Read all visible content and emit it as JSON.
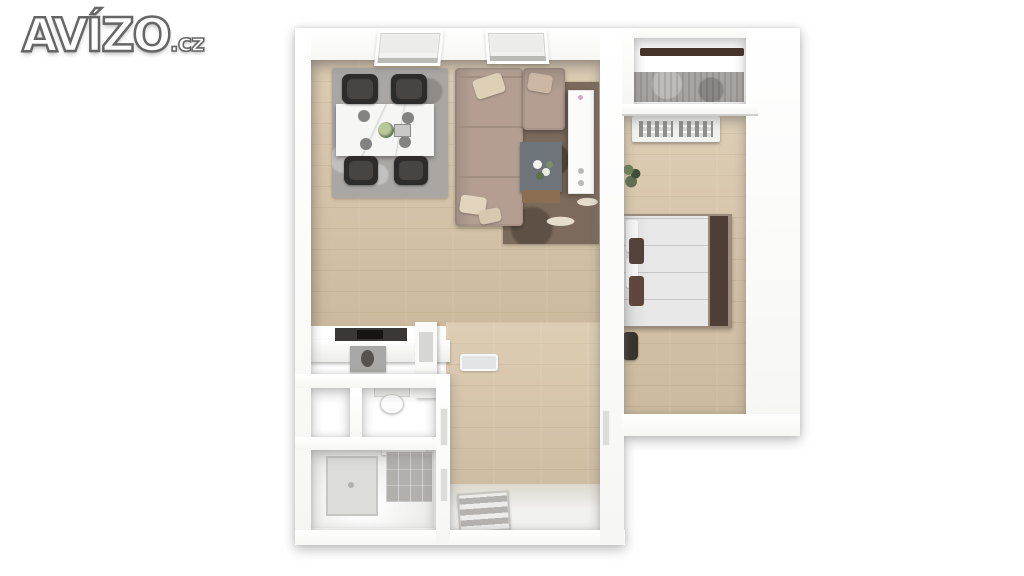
{
  "logo": {
    "text": "AVÍZO",
    "suffix": ".cz"
  },
  "colors": {
    "page-bg": "#ffffff",
    "wall": "#f6f6f4",
    "wood": "#d7c4a6",
    "hall-white": "#f1f1f0",
    "rug-gray": "#a9a6a3",
    "rug-brown": "#7c6a5c",
    "rug-pattern": "#e7ddcd",
    "sofa": "#b39e91",
    "sofa-seam": "#a28e81",
    "pillow-cream": "#decfb7",
    "chair-dark": "#2e2c2a",
    "table-white": "#f6f6f4",
    "coffee-table": "#6e757a",
    "wood-furniture": "#8a6e51",
    "bed-duvet": "#e8e8e9",
    "bed-dark": "#4e3e36",
    "throw-brown": "#54413a",
    "railing": "#46332a",
    "balcony-floor": "#a7a5a2",
    "appliance-dark": "#3a3836",
    "appliance-gray": "#a8a8a6",
    "tile": "#b2b0ad",
    "shower": "#dcdcda",
    "mat": "#b4b2ae",
    "grille": "#8f8f8d",
    "plant-green": "#5f7050",
    "logo-fill": "#fdfdfd",
    "logo-stroke": "#666666"
  },
  "floorplan": {
    "type": "3d-top-down-apartment-render",
    "rooms": [
      "living-room-with-dining",
      "kitchen-nook",
      "wc",
      "closet",
      "bathroom",
      "entry-hall",
      "bedroom",
      "balcony"
    ],
    "furniture": [
      "dining-table",
      "dining-chairs-x4",
      "gray-area-rug",
      "l-shaped-sofa",
      "throw-pillows",
      "brown-floral-rug",
      "coffee-table-with-flowers",
      "white-sideboard",
      "two-skylight-windows",
      "kitchen-counter-with-cooktop",
      "oven",
      "toilet",
      "shower",
      "tiled-wall",
      "glass-floor-tray",
      "striped-doormat",
      "double-bed-with-dark-headboard",
      "radiator",
      "potted-plant",
      "dark-armchair",
      "balcony-railing"
    ]
  }
}
